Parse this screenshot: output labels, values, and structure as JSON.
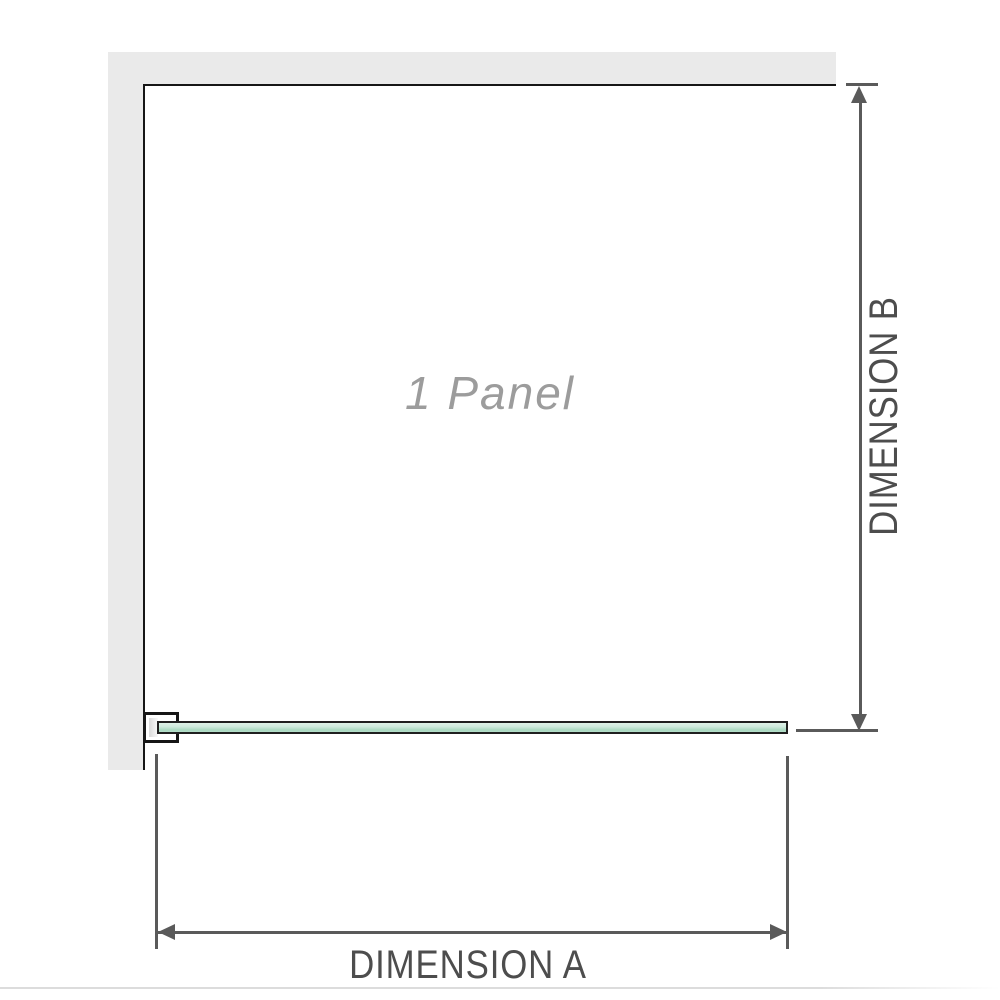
{
  "labels": {
    "panel": "1 Panel",
    "dimension_a": "DIMENSION A",
    "dimension_b": "DIMENSION B"
  },
  "colors": {
    "wall": "#eaeaea",
    "structure_line": "#161616",
    "dimension_line": "#5a5a5a",
    "label_text": "#4d4d4d",
    "panel_text": "#9c9c9c",
    "glass_border": "#1f1f1f",
    "glass_light": "#dff1e7",
    "glass_dark": "#a9d9c0",
    "baseline": "#dcdcdc"
  }
}
